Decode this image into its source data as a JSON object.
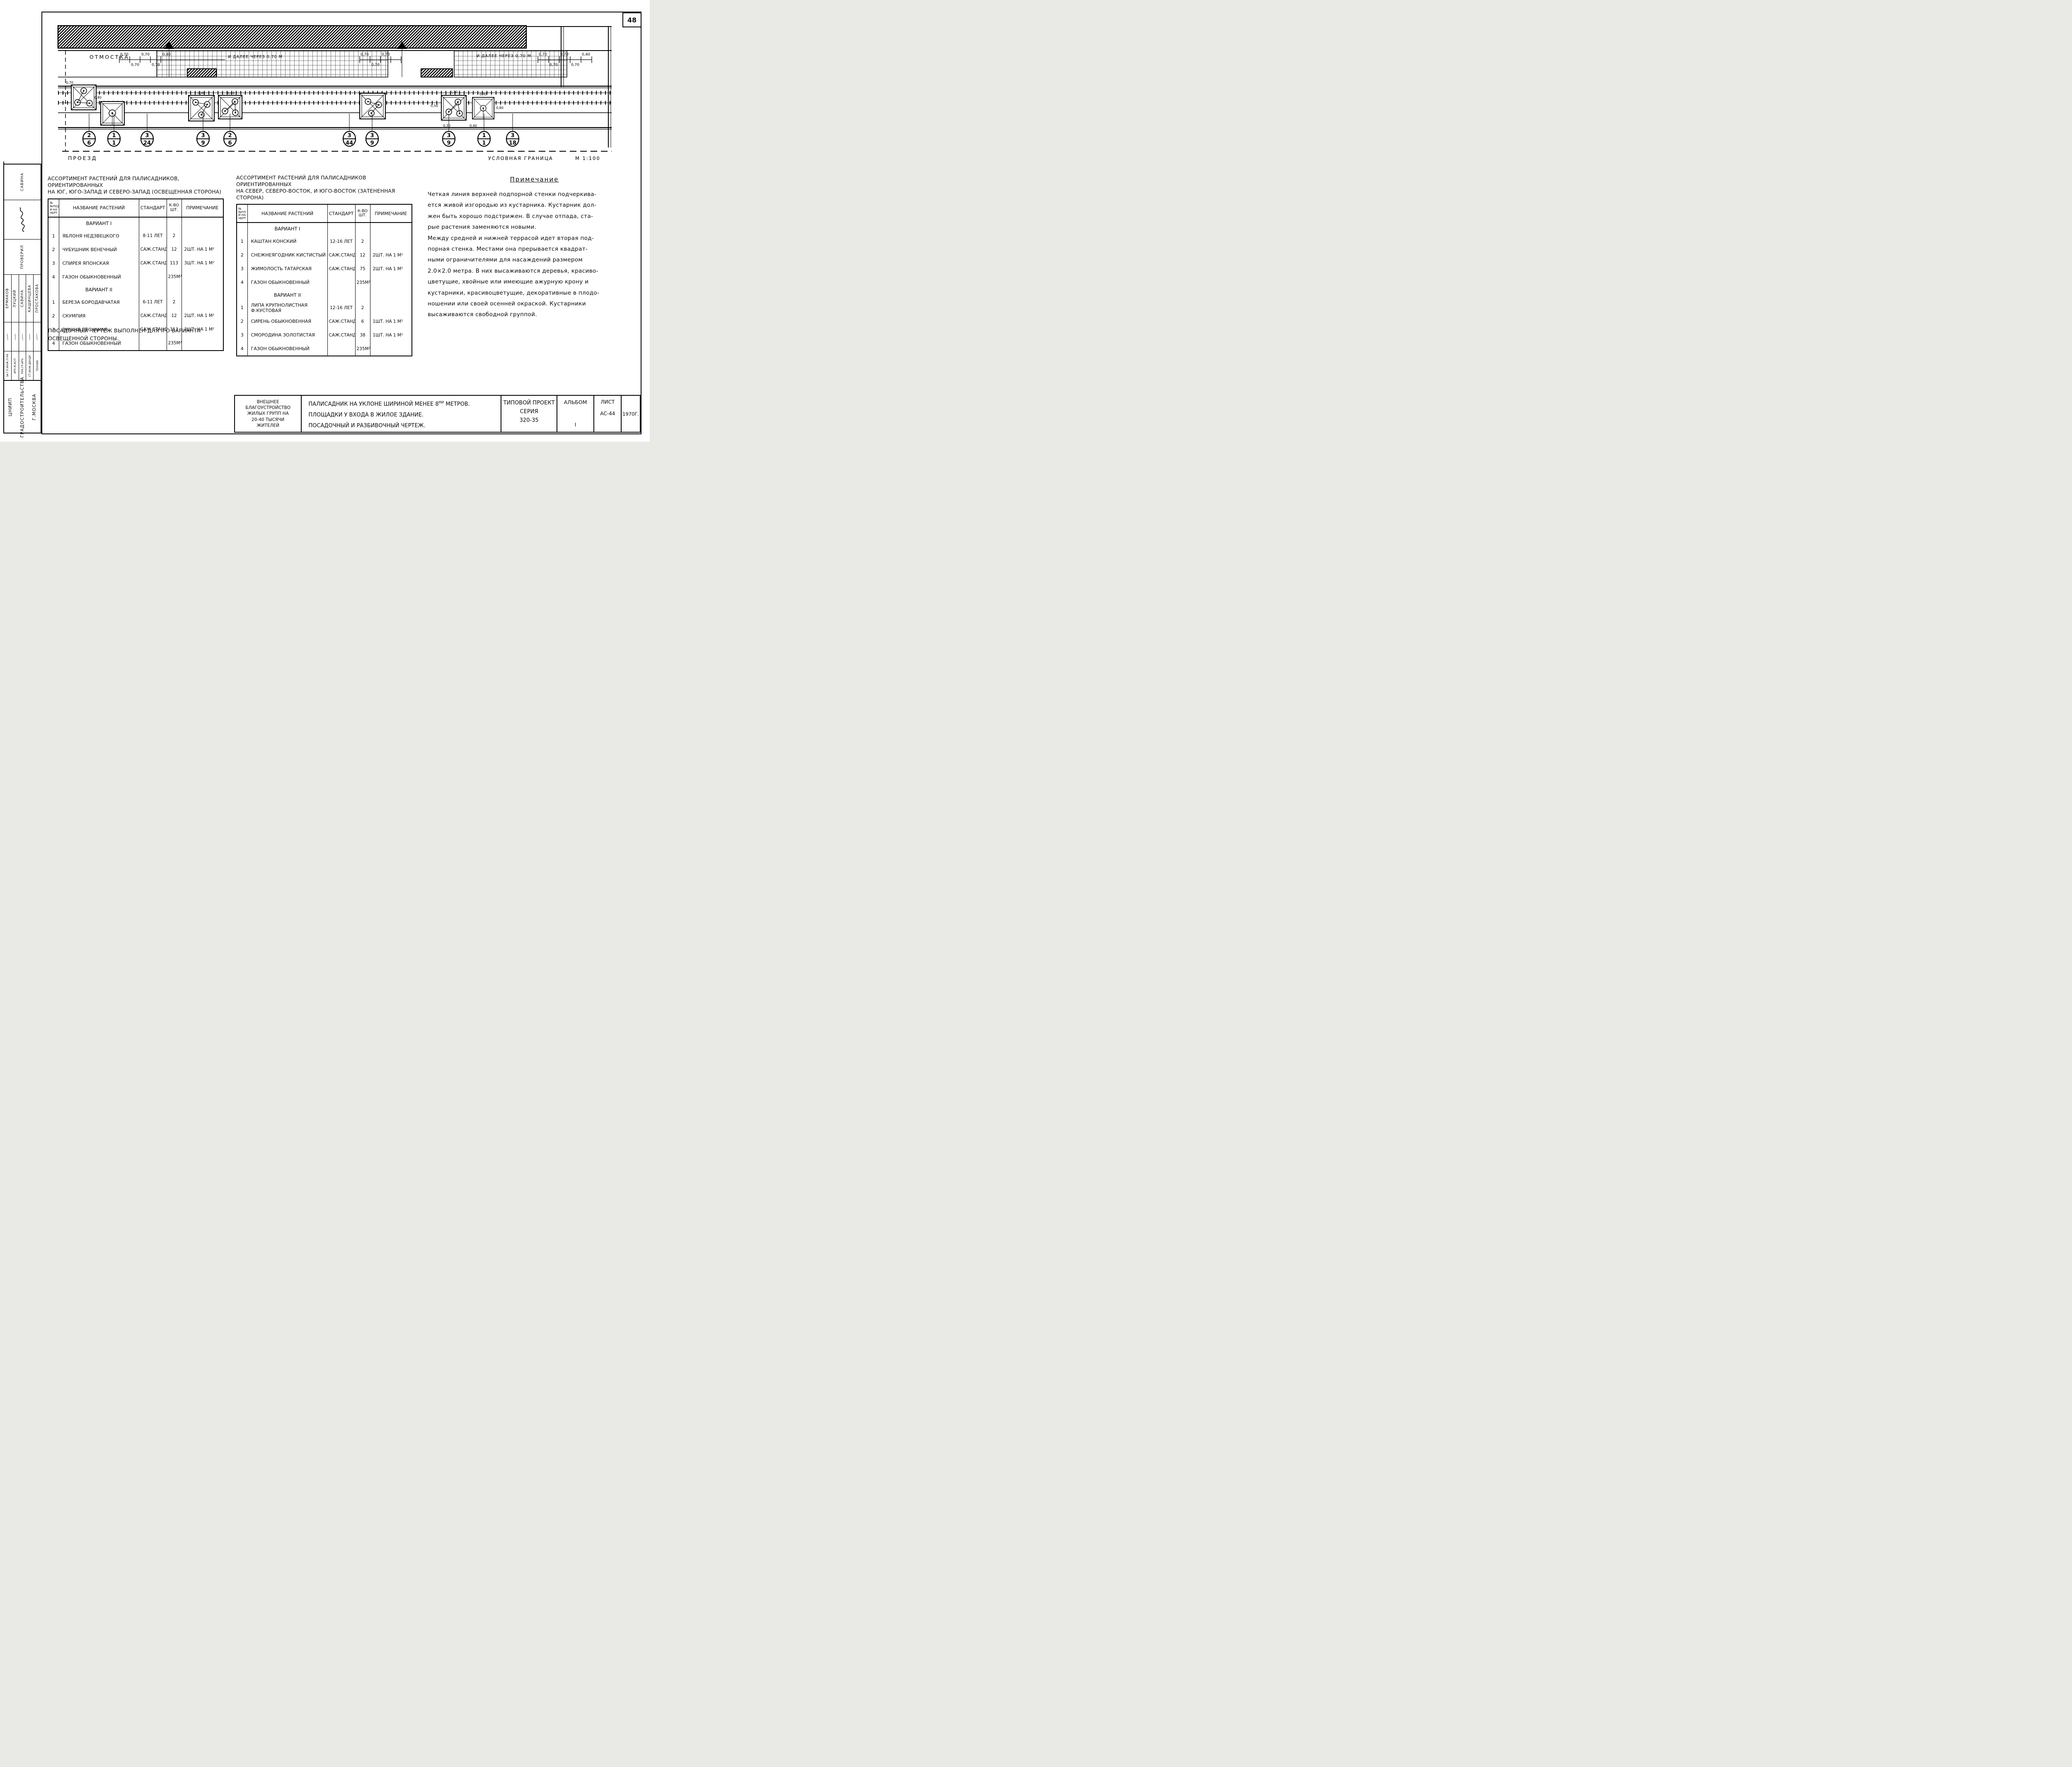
{
  "page_number": "48",
  "plan": {
    "labels": {
      "otmostka": "отмостка",
      "proezd": "проезд",
      "boundary": "условная граница",
      "scale": "М 1:100",
      "further": "и далее через 0,70 м"
    },
    "dims": {
      "d070": "0,70",
      "d040": "0,40",
      "d030": "0,30",
      "d080": "0,80",
      "d050": "0,50"
    },
    "callouts": [
      {
        "top": "2",
        "bottom": "6"
      },
      {
        "top": "1",
        "bottom": "1"
      },
      {
        "top": "3",
        "bottom": "24"
      },
      {
        "top": "3",
        "bottom": "9"
      },
      {
        "top": "2",
        "bottom": "6"
      },
      {
        "top": "3",
        "bottom": "44"
      },
      {
        "top": "3",
        "bottom": "9"
      },
      {
        "top": "3",
        "bottom": "9"
      },
      {
        "top": "1",
        "bottom": "1"
      },
      {
        "top": "3",
        "bottom": "18"
      }
    ]
  },
  "tables": {
    "left": {
      "title_lines": [
        "Ассортимент растений для палисадников, ориентированных",
        "на юг, юго-запад и северо-запад (освещенная сторона)"
      ],
      "headers": {
        "num": [
          "№№под",
          "и на",
          "черт"
        ],
        "name": "Название растений",
        "standard": "Стандарт",
        "qty": [
          "К-во",
          "шт."
        ],
        "note": "Примечание"
      },
      "sections": [
        {
          "name": "Вариант I",
          "rows": [
            [
              "1",
              "Яблоня Недзвецкого",
              "8-11 лет",
              "2",
              ""
            ],
            [
              "2",
              "Чубушник венечный",
              "саж.станд",
              "12",
              "2шт. на 1 м²"
            ],
            [
              "3",
              "Спирея японская",
              "саж.станд",
              "113",
              "3шт. на 1 м²"
            ],
            [
              "4",
              "Газон обыкновенный",
              "",
              "235м²",
              ""
            ]
          ]
        },
        {
          "name": "Вариант II",
          "rows": [
            [
              "1",
              "Береза бородавчатая",
              "6-11 лет",
              "2",
              ""
            ],
            [
              "2",
              "Скумпия",
              "саж.станд.",
              "12",
              "2шт. на 1 м²"
            ],
            [
              "3",
              "Вишня песчаная",
              "саж.станд",
              "113",
              "3шт. на 1 м²"
            ],
            [
              "4",
              "Газон обыкновенный",
              "",
              "235м²",
              ""
            ]
          ]
        }
      ]
    },
    "right": {
      "title_lines": [
        "Ассортимент растений для палисадников ориентированных",
        "на север, северо-восток, и юго-восток (затененная сторона)"
      ],
      "headers": {
        "num": [
          "№№пл",
          "и на",
          "черт"
        ],
        "name": "Название растений",
        "standard": "Стандарт",
        "qty": [
          "К-во",
          "шт."
        ],
        "note": "Примечание"
      },
      "sections": [
        {
          "name": "Вариант I",
          "rows": [
            [
              "1",
              "Каштан конский",
              "12-16 лет",
              "2",
              ""
            ],
            [
              "2",
              "Снежнеягодник кистистый",
              "саж.станд.",
              "12",
              "2шт. на 1 м²"
            ],
            [
              "3",
              "Жимолость татарская",
              "саж.станд.",
              "75",
              "2шт. на 1 м²"
            ],
            [
              "4",
              "Газон обыкновенный",
              "",
              "235м²",
              ""
            ]
          ]
        },
        {
          "name": "Вариант II",
          "rows": [
            [
              "1",
              "Липа крупнолистная ф.кустовая",
              "12-16 лет",
              "2",
              ""
            ],
            [
              "2",
              "Сирень обыкновенная",
              "саж:станд",
              "6",
              "1шт. на 1 м²"
            ],
            [
              "3",
              "Смородина золотистая",
              "саж.станд",
              "38",
              "1шт. на 1 м²"
            ],
            [
              "4",
              "Газон обыкновенный",
              "",
              "235м²",
              ""
            ]
          ]
        }
      ]
    }
  },
  "footnote_lines": [
    "Посадочный чертеж выполнен для Iго варианта",
    "освещенной стороны."
  ],
  "note": {
    "title": "Примечание",
    "lines": [
      "Четкая линия верхней подпорной стенки подчеркива-",
      "ется живой изгородью из кустарника. Кустарник дол-",
      "жен быть хорошо подстрижен. В случае отпада, ста-",
      "рые растения заменяются новыми.",
      "Между средней и нижней террасой идет вторая под-",
      "порная стенка. Местами она прерывается квадрат-",
      "ными ограничителями для насаждений размером",
      "2.0×2.0 метра. В них высаживаются деревья, красиво-",
      "цветущие, хвойные или имеющие ажурную крону и",
      "кустарники, красивоцветущие, декоративные в плодо-",
      "ношении или своей осенней окраской. Кустарники",
      "высаживаются свободной группой."
    ]
  },
  "titleblock": {
    "project_lines": [
      "Внешнее благоустройство",
      "жилых групп на",
      "20-40 тысячи",
      "жителей"
    ],
    "caption": {
      "l1_pre": "Палисадник на уклоне шириной    менее 8",
      "l1_sup": "ми",
      "l1_post": " метров.",
      "l2": "Площадки у входа в жилое   здание.",
      "l3": "Посадочный и разбивочный   чертеж."
    },
    "type_label": "Типовой проект",
    "series_label": "Серия",
    "series_value": "320-35",
    "album_label": "Альбом",
    "album_value": "I",
    "sheet_label": "Лист",
    "sheet_value": "АС-44",
    "year": "1970г."
  },
  "sidebar": {
    "checked_name": "Савина",
    "checked_label": "Проверил",
    "people": [
      {
        "role": "За гл.инж.п-ра",
        "name": "Ермаков"
      },
      {
        "role": "Арх.м.асп.",
        "name": "Луцкий"
      },
      {
        "role": "Рук.гр.арх.",
        "name": "Савина"
      },
      {
        "role": "Ст.инж.дендр.",
        "name": "Кашинцева"
      },
      {
        "role": "Техник",
        "name": "Простакова"
      }
    ],
    "org_lines": [
      "ЦНИИП",
      "Градостроительства",
      "г.Москва"
    ]
  }
}
